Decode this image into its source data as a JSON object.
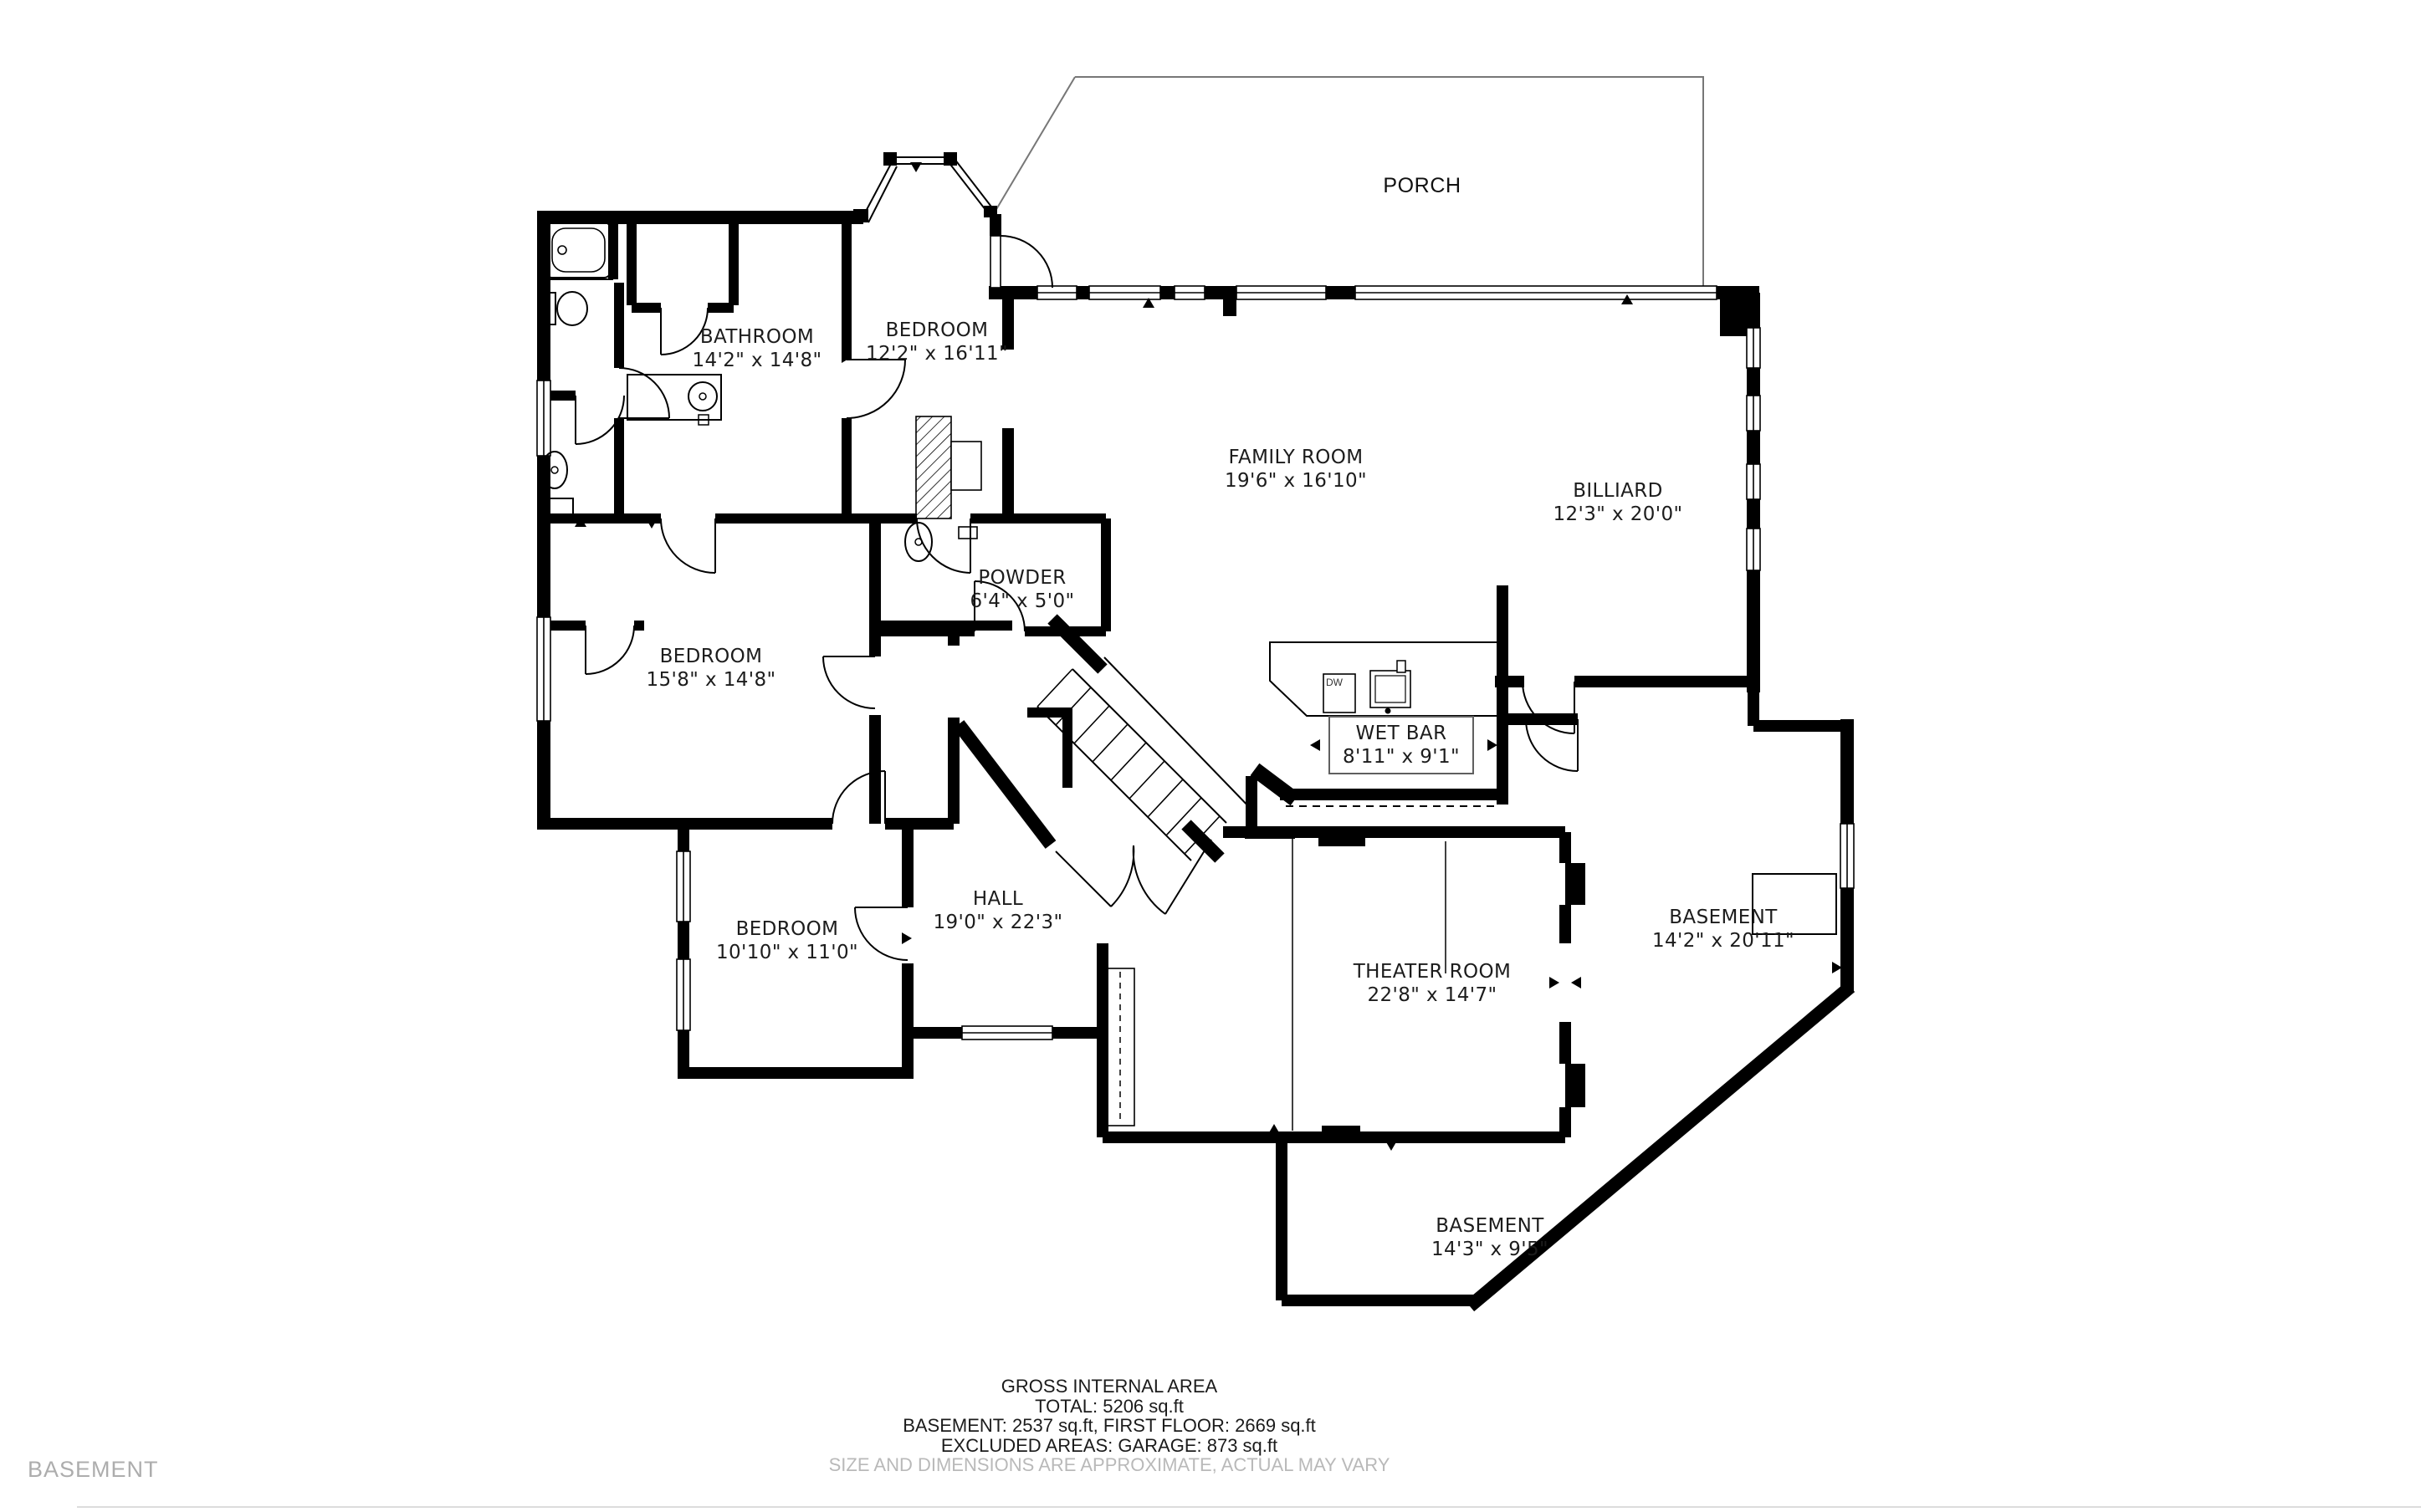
{
  "page": {
    "background": "#ffffff",
    "wall_color": "#000000",
    "muted_color": "#adadad",
    "floor_tag": "BASEMENT"
  },
  "rooms": [
    {
      "id": "porch",
      "name": "PORCH",
      "dims": ""
    },
    {
      "id": "bedroom-top",
      "name": "BEDROOM",
      "dims": "12'2\" x 16'11\""
    },
    {
      "id": "bathroom",
      "name": "BATHROOM",
      "dims": "14'2\" x 14'8\""
    },
    {
      "id": "family-room",
      "name": "FAMILY ROOM",
      "dims": "19'6\" x 16'10\""
    },
    {
      "id": "billiard",
      "name": "BILLIARD",
      "dims": "12'3\" x 20'0\""
    },
    {
      "id": "powder",
      "name": "POWDER",
      "dims": "6'4\" x 5'0\""
    },
    {
      "id": "bedroom-middle",
      "name": "BEDROOM",
      "dims": "15'8\" x 14'8\""
    },
    {
      "id": "wet-bar",
      "name": "WET BAR",
      "dims": "8'11\" x 9'1\""
    },
    {
      "id": "hall",
      "name": "HALL",
      "dims": "19'0\" x 22'3\""
    },
    {
      "id": "bedroom-small",
      "name": "BEDROOM",
      "dims": "10'10\" x 11'0\""
    },
    {
      "id": "theater-room",
      "name": "THEATER ROOM",
      "dims": "22'8\" x 14'7\""
    },
    {
      "id": "basement-right",
      "name": "BASEMENT",
      "dims": "14'2\" x 20'11\""
    },
    {
      "id": "basement-bottom",
      "name": "BASEMENT",
      "dims": "14'3\" x 9'5\""
    }
  ],
  "fixtures": {
    "dishwasher_label": "DW"
  },
  "footer": {
    "line1": "GROSS INTERNAL AREA",
    "line2": "TOTAL: 5206 sq.ft",
    "line3": "BASEMENT: 2537 sq.ft, FIRST FLOOR: 2669 sq.ft",
    "line4": "EXCLUDED AREAS: GARAGE: 873 sq.ft",
    "disclaimer": "SIZE AND DIMENSIONS ARE APPROXIMATE, ACTUAL MAY VARY"
  }
}
